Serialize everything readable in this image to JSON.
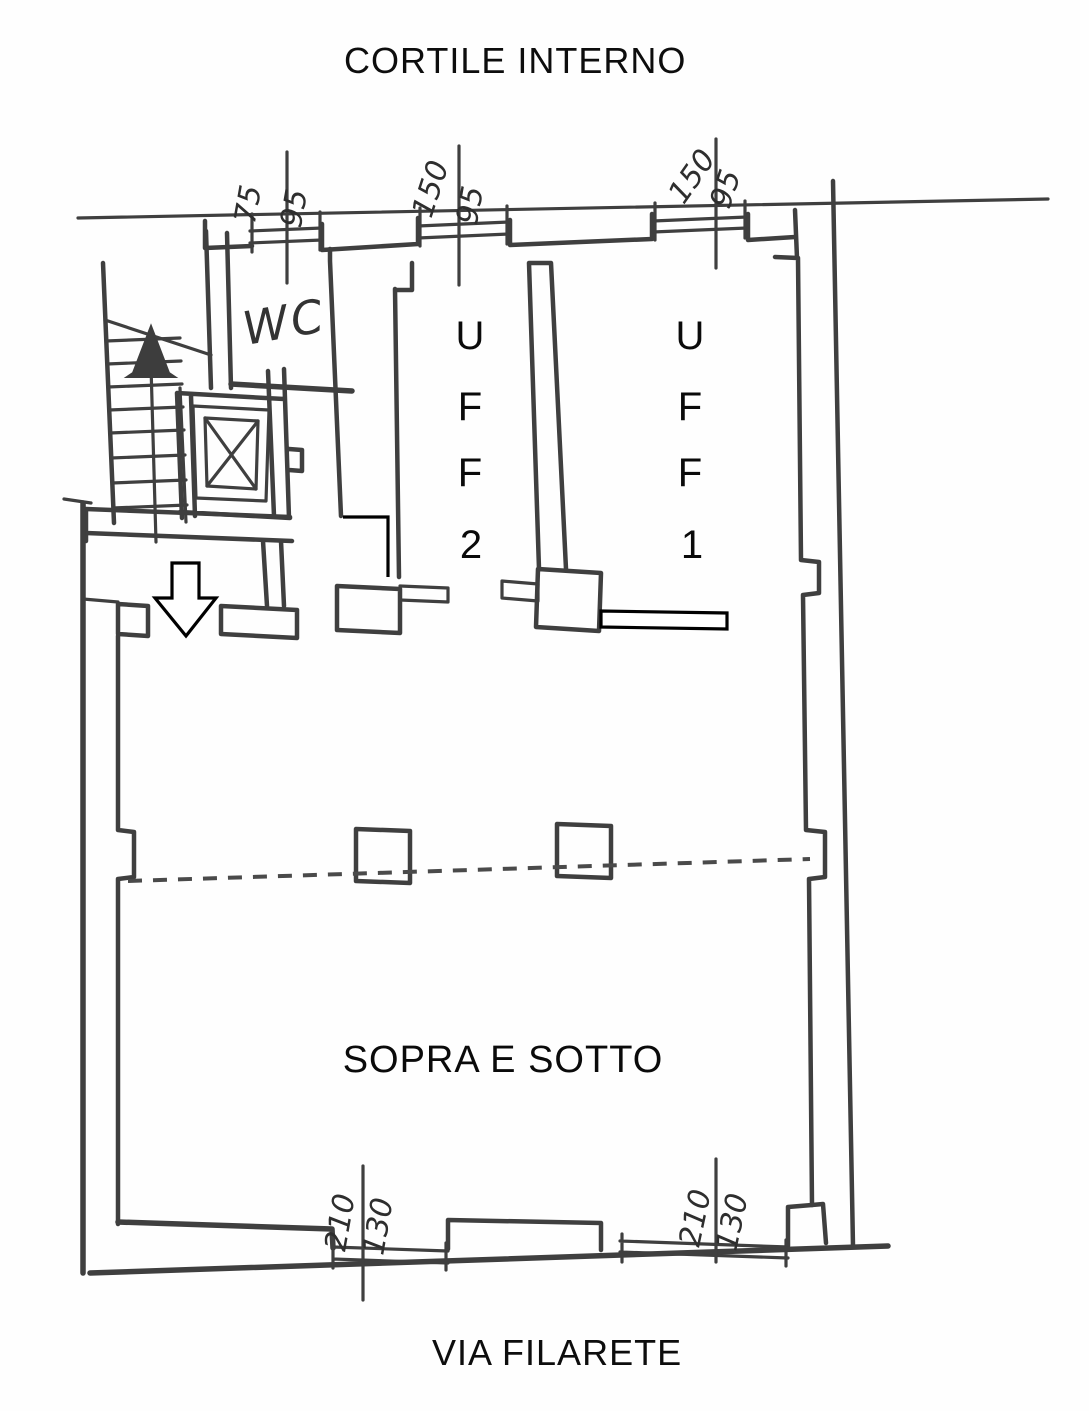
{
  "titles": {
    "top": "CORTILE INTERNO",
    "bottom": "VIA FILARETE"
  },
  "rooms": {
    "office2": {
      "letters": [
        "U",
        "F",
        "F"
      ],
      "number": "2"
    },
    "office1": {
      "letters": [
        "U",
        "F",
        "F"
      ],
      "number": "1"
    },
    "main": {
      "label": "SOPRA E SOTTO"
    },
    "wc": {
      "label": "WC"
    }
  },
  "dimensions": {
    "top_window_left": {
      "w": "75",
      "h": "95"
    },
    "top_window_mid": {
      "w": "150",
      "h": "95"
    },
    "top_window_right": {
      "w": "150",
      "h": "95"
    },
    "bottom_window_left": {
      "w": "210",
      "h": "130"
    },
    "bottom_window_right": {
      "w": "210",
      "h": "130"
    }
  },
  "colors": {
    "ink": "#3f3f3f",
    "annotation": "#000000",
    "paper": "#fefefe"
  }
}
